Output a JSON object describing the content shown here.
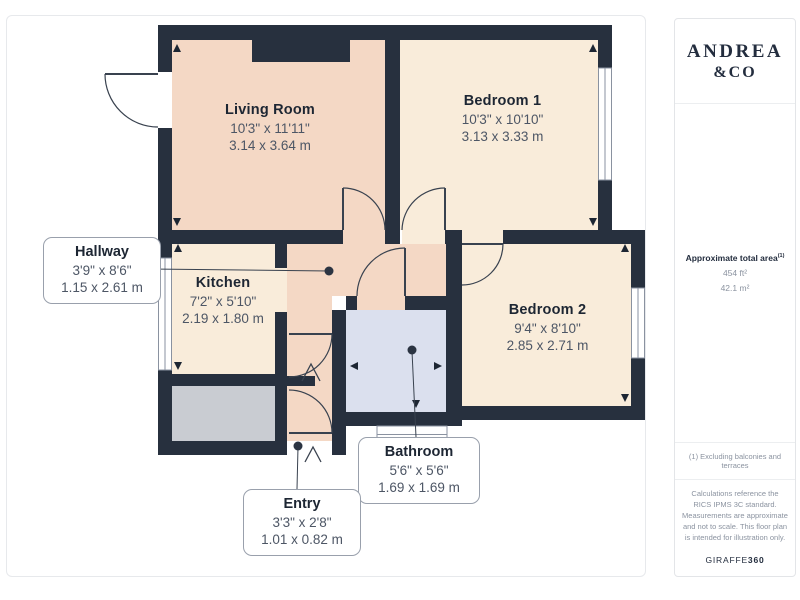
{
  "branding": {
    "logo_line1": "ANDREA",
    "logo_line2": "&CO"
  },
  "sidebar": {
    "area_heading": "Approximate total area",
    "area_heading_note": "(1)",
    "area_imperial": "454 ft²",
    "area_metric": "42.1 m²",
    "footnote": "(1) Excluding balconies and terraces",
    "disclaimer": "Calculations reference the RICS IPMS 3C standard. Measurements are approximate and not to scale. This floor plan is intended for illustration only.",
    "brand_name": "GIRAFFE",
    "brand_number": "360"
  },
  "rooms": {
    "living_room": {
      "name": "Living Room",
      "imperial": "10'3\" x 11'11\"",
      "metric": "3.14 x 3.64 m"
    },
    "bedroom1": {
      "name": "Bedroom 1",
      "imperial": "10'3\" x 10'10\"",
      "metric": "3.13 x 3.33 m"
    },
    "bedroom2": {
      "name": "Bedroom 2",
      "imperial": "9'4\" x 8'10\"",
      "metric": "2.85 x 2.71 m"
    },
    "kitchen": {
      "name": "Kitchen",
      "imperial": "7'2\" x 5'10\"",
      "metric": "2.19 x 1.80 m"
    },
    "hallway": {
      "name": "Hallway",
      "imperial": "3'9\" x 8'6\"",
      "metric": "1.15 x 2.61 m"
    },
    "bathroom": {
      "name": "Bathroom",
      "imperial": "5'6\" x 5'6\"",
      "metric": "1.69 x 1.69 m"
    },
    "entry": {
      "name": "Entry",
      "imperial": "3'3\" x 2'8\"",
      "metric": "1.01 x 0.82 m"
    }
  },
  "colors": {
    "wall": "#27303e",
    "room_peach": "#f4d8c5",
    "room_cream": "#f9ecda",
    "room_blue": "#dbe0ee",
    "room_gray": "#c9ccd2",
    "line": "#39424f",
    "logo_navy": "#232d3e"
  }
}
